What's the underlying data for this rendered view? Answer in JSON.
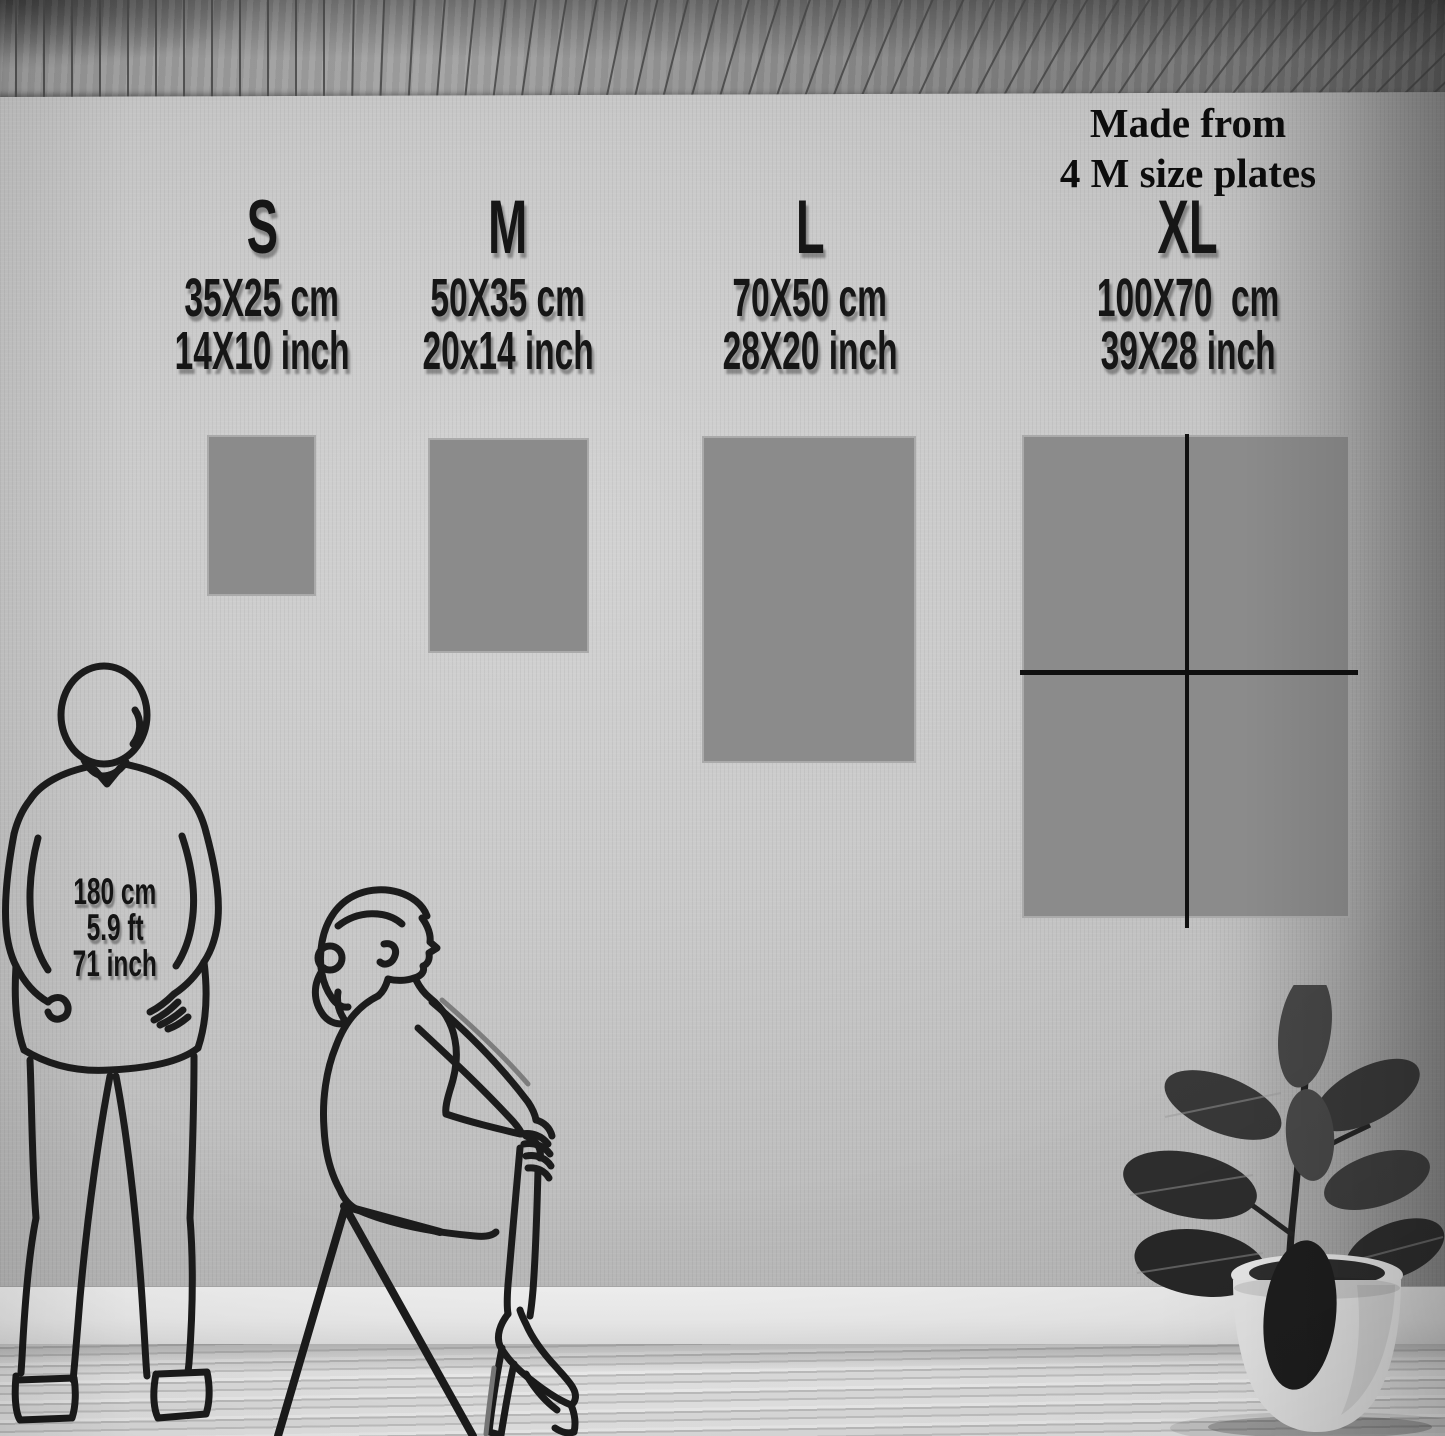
{
  "xl_note": {
    "line1": "Made from",
    "line2": "4 M size plates"
  },
  "sizes": [
    {
      "label": "S",
      "cm": "35X25 cm",
      "inch": "14X10 inch"
    },
    {
      "label": "M",
      "cm": "50X35 cm",
      "inch": "20x14 inch"
    },
    {
      "label": "L",
      "cm": "70X50 cm",
      "inch": "28X20 inch"
    },
    {
      "label": "XL",
      "cm": "100X70  cm",
      "inch": "39X28 inch"
    }
  ],
  "reference_person": {
    "height_cm": "180 cm",
    "height_ft": "5.9 ft",
    "height_inch": "71 inch"
  },
  "colors": {
    "wall": "#c7c7c7",
    "poster_fill": "#8b8b8b",
    "text": "#141414",
    "plate_divider": "#101010"
  }
}
